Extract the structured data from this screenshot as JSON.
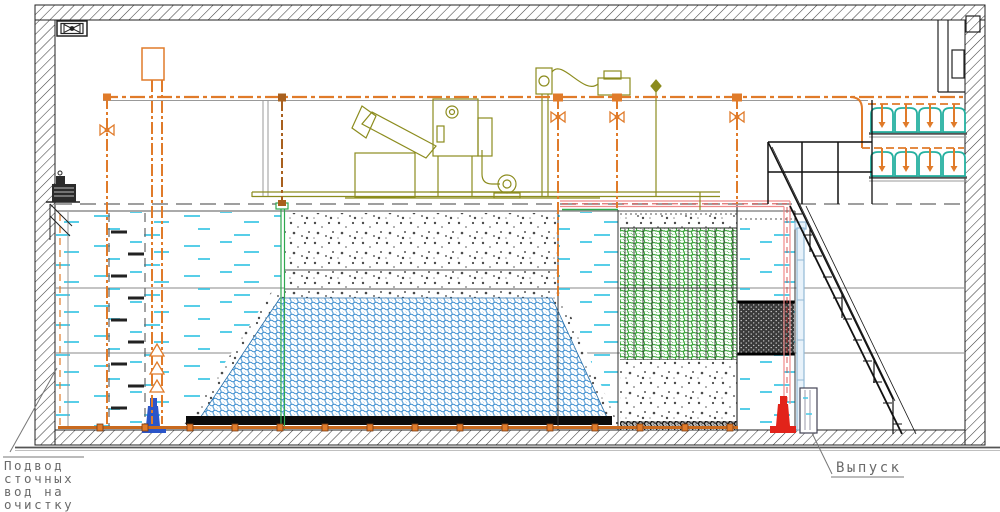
{
  "drawing": {
    "kind": "wastewater-treatment-plant-section",
    "language": "ru"
  },
  "labels": {
    "inlet_line1": "Подвод",
    "inlet_line2": "сточных",
    "inlet_line3": "вод на",
    "inlet_line4": "очистку",
    "outlet": "Выпуск"
  },
  "colors": {
    "pipe_orange": "#E07B2A",
    "equipment_olive": "#8C8C1E",
    "water_dash": "#45C8E6",
    "media_blue": "#3E8FD0",
    "media_green": "#3AA33A",
    "bell_teal": "#25B0A0",
    "pump_inlet_blue": "#2B55C8",
    "pump_outlet_red": "#E2231A",
    "pipe_pink": "#F08A8A",
    "pipe_lightblue": "#93B9D6",
    "divider_green": "#2FA84F",
    "structure": "#1A1A1A"
  },
  "equipment": {
    "aeration_bells_rows": 2,
    "aeration_bells_per_row": 4,
    "icons": [
      "wall-fan-icon",
      "valve-icon",
      "pump-icon"
    ]
  }
}
